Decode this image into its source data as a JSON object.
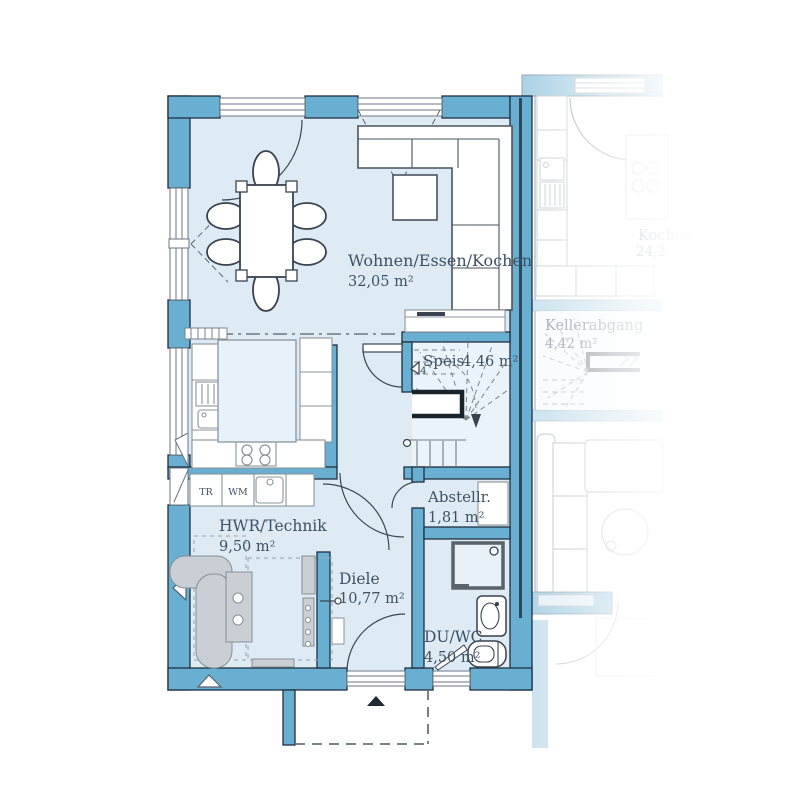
{
  "plan": {
    "type": "floor-plan",
    "unit": {
      "rooms": [
        {
          "id": "wohnen-essen-kochen",
          "label": "Wohnen/Essen/Kochen",
          "area": "32,05 m²"
        },
        {
          "id": "speis",
          "label": "Speis",
          "area": "4,46 m²"
        },
        {
          "id": "abstellraum",
          "label": "Abstellr.",
          "area": "1,81 m²"
        },
        {
          "id": "hwr-technik",
          "label": "HWR/Technik",
          "area": "9,50 m²"
        },
        {
          "id": "diele",
          "label": "Diele",
          "area": "10,77 m²"
        },
        {
          "id": "du-wc",
          "label": "DU/WC",
          "area": "4,50 m²"
        }
      ],
      "appliance_labels": {
        "dryer": "TR",
        "washer": "WM"
      },
      "stair_step_marker": "4"
    },
    "neighbor_unit": {
      "rooms": [
        {
          "id": "kellerabgang",
          "label": "Kellerabgang",
          "area": "4,42 m²"
        },
        {
          "id": "kochen",
          "label": "Kochen",
          "area": "24,2"
        }
      ]
    },
    "colors": {
      "wall": "#68AFD2",
      "wall_outline": "#1F3040",
      "party_wall_core": "#39444D",
      "floor": "#DEEBF5",
      "stair_floor": "#EAF3FA",
      "island_fill": "#E7F1F9",
      "equipment": "#C9CFD4",
      "furniture_line": "#39434D",
      "text": "#3D5164"
    }
  }
}
